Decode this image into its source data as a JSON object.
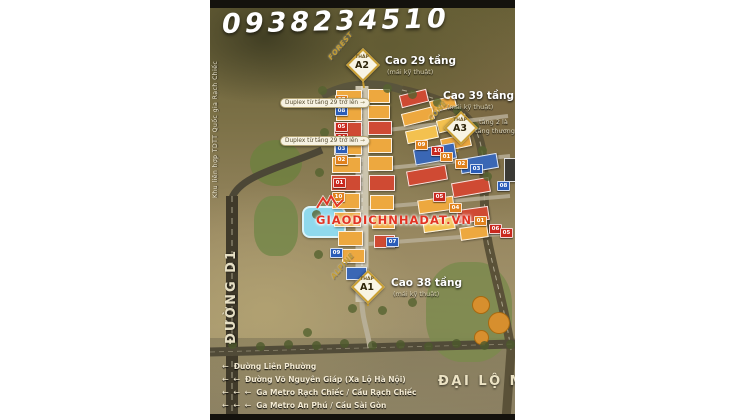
{
  "page": {
    "background": "#ffffff"
  },
  "header": {
    "phone": "0938234510"
  },
  "map": {
    "left_edge_label": "Khu liên hợp TDTT Quốc gia Rạch Chiếc",
    "road_d1": "ĐƯỜNG D1",
    "avenue": "ĐẠI LỘ MA",
    "watermark": "GIAODICHNHADAT.VN"
  },
  "towers": [
    {
      "prefix": "THÁP",
      "name": "A2",
      "zone": "FOREST",
      "height": "Cao 29 tầng",
      "sub": "(mái kỹ thuật)"
    },
    {
      "prefix": "THÁP",
      "name": "A3",
      "zone": "CONE",
      "height": "Cao 39 tầng",
      "sub": "(mái kỹ thuật)",
      "note1": "tầng 2 là",
      "note2": "tầng thương mại"
    },
    {
      "prefix": "THÁP",
      "name": "A1",
      "zone": "ALPINE",
      "height": "Cao 38 tầng",
      "sub": "(mái kỹ thuật)"
    }
  ],
  "callouts": [
    {
      "text": "Duplex từ tầng 29 trở lên"
    },
    {
      "text": "Duplex từ tầng 29 trở lên"
    }
  ],
  "legend": {
    "items": [
      {
        "arrows": 1,
        "label": "Đường Liên Phường",
        "y": 362
      },
      {
        "arrows": 2,
        "label": "Đường Võ Nguyên Giáp (Xa Lộ Hà Nội)",
        "y": 375
      },
      {
        "arrows": 3,
        "label": "Ga Metro Rạch Chiếc / Cầu Rạch Chiếc",
        "y": 388
      },
      {
        "arrows": 3,
        "label": "Ga Metro An Phú / Cầu Sài Gòn",
        "y": 401
      }
    ]
  },
  "badges": [
    {
      "n": "07",
      "color": "orange",
      "x": 125,
      "y": 95
    },
    {
      "n": "08",
      "color": "blue",
      "x": 125,
      "y": 106
    },
    {
      "n": "05",
      "color": "red",
      "x": 125,
      "y": 122
    },
    {
      "n": "04",
      "color": "red",
      "x": 125,
      "y": 133
    },
    {
      "n": "03",
      "color": "blue",
      "x": 125,
      "y": 144
    },
    {
      "n": "02",
      "color": "orange",
      "x": 125,
      "y": 155
    },
    {
      "n": "01",
      "color": "red",
      "x": 123,
      "y": 178
    },
    {
      "n": "10",
      "color": "orange",
      "x": 122,
      "y": 192
    },
    {
      "n": "09",
      "color": "blue",
      "x": 120,
      "y": 248
    },
    {
      "n": "09",
      "color": "orange",
      "x": 205,
      "y": 140
    },
    {
      "n": "10",
      "color": "red",
      "x": 221,
      "y": 146
    },
    {
      "n": "01",
      "color": "orange",
      "x": 230,
      "y": 152
    },
    {
      "n": "02",
      "color": "orange",
      "x": 245,
      "y": 159
    },
    {
      "n": "03",
      "color": "blue",
      "x": 260,
      "y": 164
    },
    {
      "n": "08",
      "color": "blue",
      "x": 287,
      "y": 181
    },
    {
      "n": "05",
      "color": "red",
      "x": 223,
      "y": 192
    },
    {
      "n": "04",
      "color": "orange",
      "x": 239,
      "y": 203
    },
    {
      "n": "01",
      "color": "orange",
      "x": 264,
      "y": 216
    },
    {
      "n": "06",
      "color": "red",
      "x": 279,
      "y": 224
    },
    {
      "n": "05",
      "color": "red",
      "x": 290,
      "y": 228
    },
    {
      "n": "07",
      "color": "blue",
      "x": 176,
      "y": 237
    }
  ],
  "colors": {
    "accent_gold": "#caa035",
    "badge_red": "#c9281e",
    "badge_orange": "#e0811c",
    "badge_blue": "#2a5cb8",
    "watermark_red": "#e23423"
  }
}
